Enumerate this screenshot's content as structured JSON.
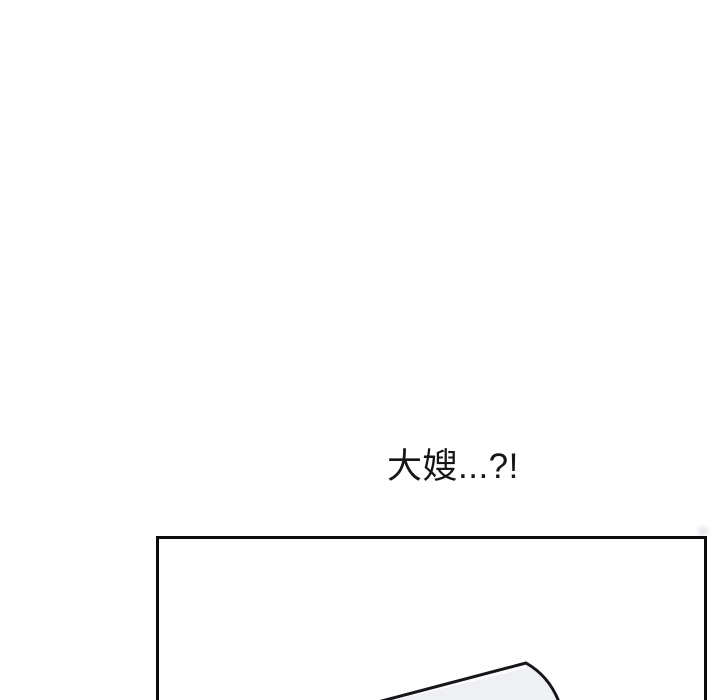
{
  "speech": {
    "text": "大嫂...?!",
    "color": "#161616"
  },
  "panel": {
    "border_color": "#0c0c0c",
    "background": "#ffffff"
  },
  "artwork": {
    "outline_color": "#15161a",
    "fill_color": "#eff0f3",
    "highlight_color": "#fdfdfe"
  }
}
